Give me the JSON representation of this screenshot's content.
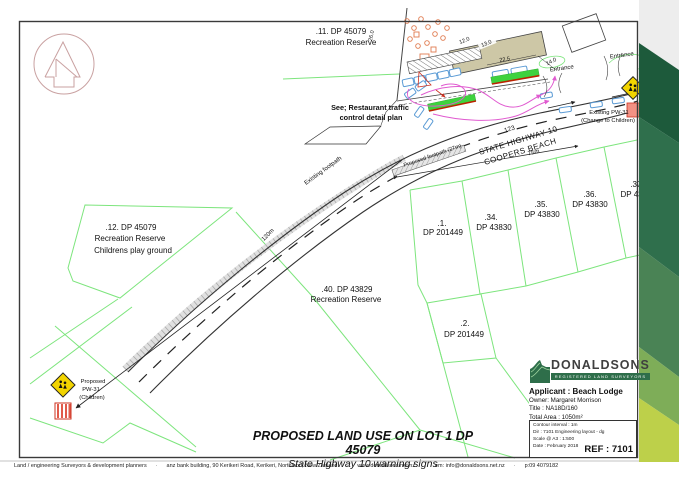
{
  "map": {
    "parcels": {
      "lot11": {
        "num": ".11. DP 45079",
        "name": "Recreation Reserve"
      },
      "lot12": {
        "num": ".12. DP 45079",
        "name": "Recreation Reserve",
        "note": "Childrens play ground"
      },
      "lot40": {
        "num": ".40. DP 43829",
        "name": "Recreation Reserve"
      },
      "lot1": {
        "num": ".1.",
        "dp": "DP 201449"
      },
      "lot2": {
        "num": ".2.",
        "dp": "DP 201449"
      },
      "lot34": {
        "num": ".34.",
        "dp": "DP 43830"
      },
      "lot35": {
        "num": ".35.",
        "dp": "DP 43830"
      },
      "lot36": {
        "num": ".36.",
        "dp": "DP 43830"
      },
      "lot37": {
        "num": ".37.",
        "dp": "DP 4383"
      }
    },
    "road": {
      "number": "123",
      "name": "STATE HIGHWAY 10",
      "locality": "COOPERS BEACH",
      "dim_75": "75m",
      "dim_120": "120m",
      "existing_footpath": "Existing footpath",
      "proposed_footpath": "Proposed footpath (27m)"
    },
    "note": {
      "line1": "See; Restaurant traffic",
      "line2": "control detail plan"
    },
    "entrance1": "Entrance",
    "entrance2": "Entrance",
    "signs": {
      "existing": {
        "line1": "Existing PW-31",
        "line2": "(Change to Children)"
      },
      "proposed": {
        "line1": "Proposed",
        "line2": "PW-31",
        "line3": "(Children)"
      }
    },
    "inset_dims": {
      "d12": "12.0",
      "d13": "13.0",
      "d22": "22.5",
      "d14": "14.0",
      "d26": "26.0"
    }
  },
  "title_block": {
    "brand": "DONALDSONS",
    "brand_sub": "REGISTERED LAND SURVEYORS",
    "applicant": "Applicant  : Beach Lodge",
    "owner": "Owner: Margaret Morrison",
    "title": "Title  : NA18D/160",
    "total_area": "Total Area : 1050m²",
    "contour": "Contour interval : 1m",
    "drawing": "Dir : 7101 Engineering layout - dg",
    "scale": "Scale @ A3 : 1:500",
    "date": "Date : February 2018",
    "ref": "REF : 7101"
  },
  "titles": {
    "main": "PROPOSED LAND USE ON LOT 1 DP 45079",
    "sub": "State Highway 10 warning signs"
  },
  "footer": {
    "items": [
      "Land / engineering Surveyors & development planners",
      "anz bank building, 90 Kerikeri Road, Kerikeri, Northland, New Zealand",
      "www.donaldsons.net.nz",
      "em: info@donaldsons.net.nz",
      "p:09 4079182"
    ]
  },
  "colors": {
    "boundary_green": "#7de57d",
    "brand_green": "#2e6e4a",
    "stripe_1": "#1d5a3b",
    "stripe_2": "#2f6f4c",
    "stripe_3": "#4a8355",
    "stripe_4": "#7ead58",
    "stripe_5": "#bdd04a",
    "sign_yellow": "#f2d400",
    "sign_pink": "#f29184",
    "landscape_green": "#3ed23e",
    "traffic_magenta": "#e05ad0",
    "building_tan": "#cdc7a6",
    "north_pink": "#c9a1a1"
  }
}
